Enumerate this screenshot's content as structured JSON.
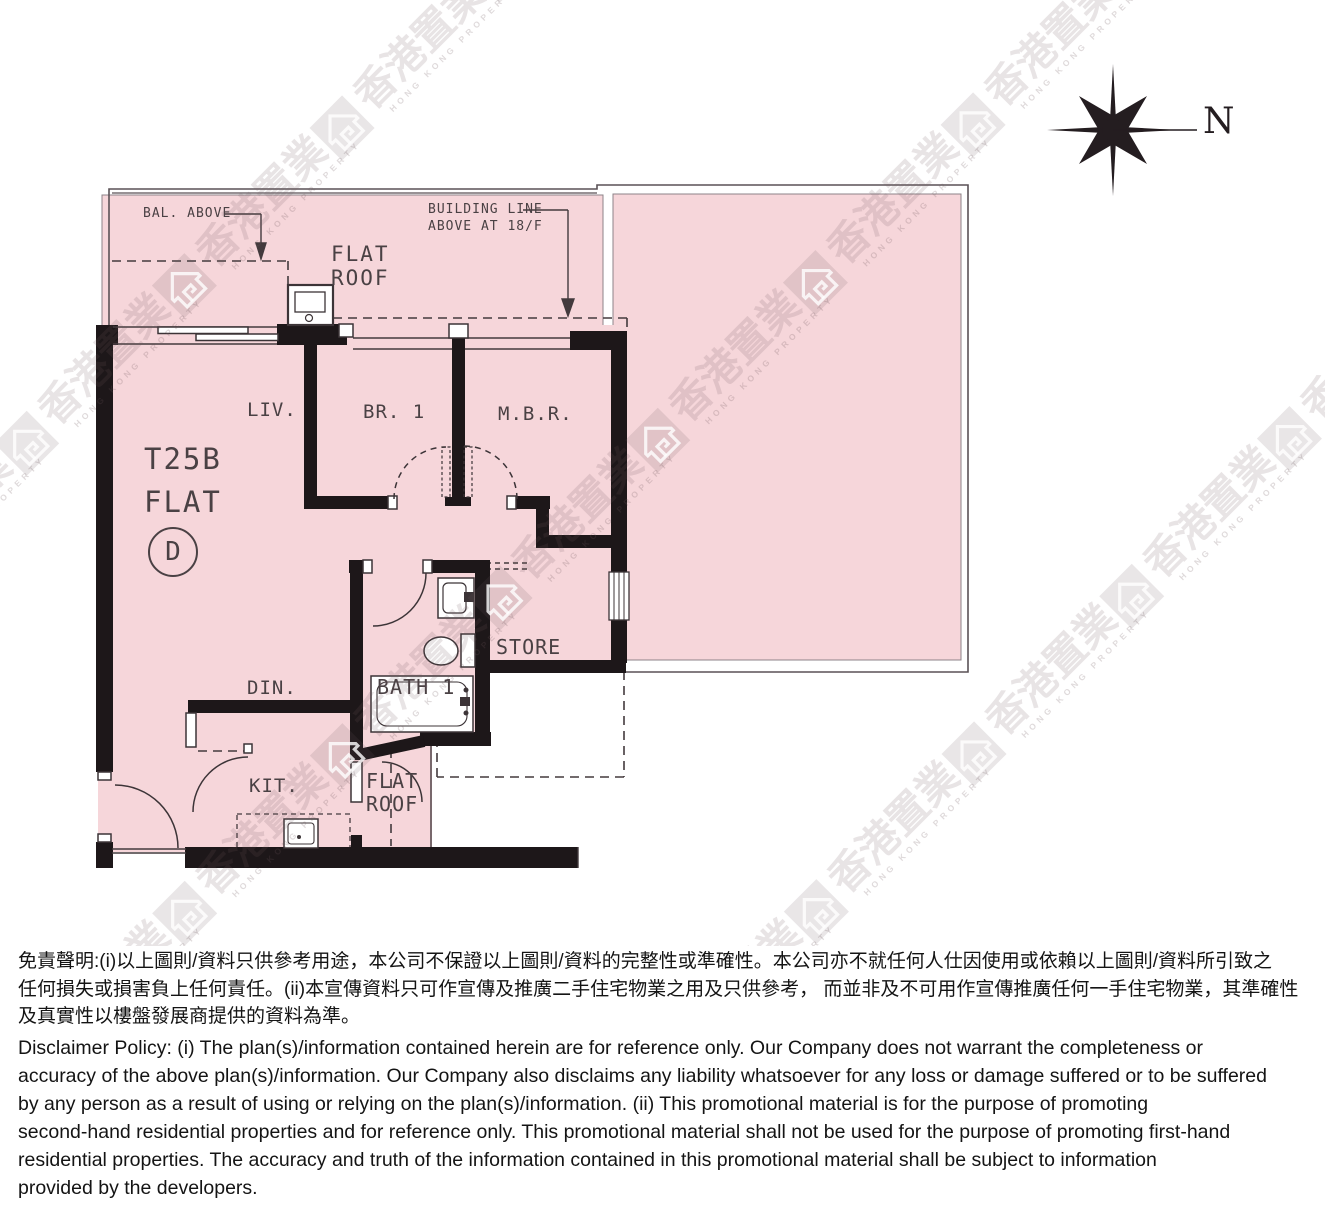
{
  "watermark": {
    "cjk": "香港置業",
    "latin": "HONG KONG PROPERTY"
  },
  "compass": {
    "north_label": "N"
  },
  "plan": {
    "unit": {
      "tower": "T25B",
      "flat_word": "FLAT",
      "flat_letter": "D"
    },
    "rooms": {
      "living": "LIV.",
      "bedroom1": "BR. 1",
      "master": "M.B.R.",
      "dining": "DIN.",
      "kitchen": "KIT.",
      "bath": "BATH 1",
      "store": "STORE",
      "flat_roof_top": "FLAT\nROOF",
      "flat_roof_bottom": "FLAT\nROOF"
    },
    "annotations": {
      "bal_above": "BAL. ABOVE",
      "building_line_1": "BUILDING LINE",
      "building_line_2": "ABOVE AT 18/F"
    }
  },
  "colors": {
    "plan_pink": "#f6d6da",
    "wall_black": "#1d1719",
    "line_dark": "#433a3d",
    "watermark_base": "#6e555c"
  },
  "disclaimer": {
    "zh_lines": [
      "免責聲明:(i)以上圖則/資料只供參考用途，本公司不保證以上圖則/資料的完整性或準確性。本公司亦不就任何人仕因使用或依賴以上圖則/資料所引致之",
      "任何損失或損害負上任何責任。(ii)本宣傳資料只可作宣傳及推廣二手住宅物業之用及只供參考， 而並非及不可用作宣傳推廣任何一手住宅物業，其準確性",
      "及真實性以樓盤發展商提供的資料為準。"
    ],
    "en_lines": [
      "Disclaimer Policy: (i) The plan(s)/information contained herein are for reference only. Our Company does not warrant the completeness or",
      "accuracy of the above plan(s)/information. Our Company also disclaims any liability whatsoever for any loss or damage suffered or to be suffered",
      "by any person as a result of using or relying on the plan(s)/information. (ii) This promotional material is for the purpose of promoting",
      "second-hand residential properties and for reference only. This promotional material shall not be used for the purpose of promoting first-hand",
      "residential properties. The accuracy and truth of the information contained in this promotional material shall be subject to information",
      "provided by the developers."
    ]
  }
}
